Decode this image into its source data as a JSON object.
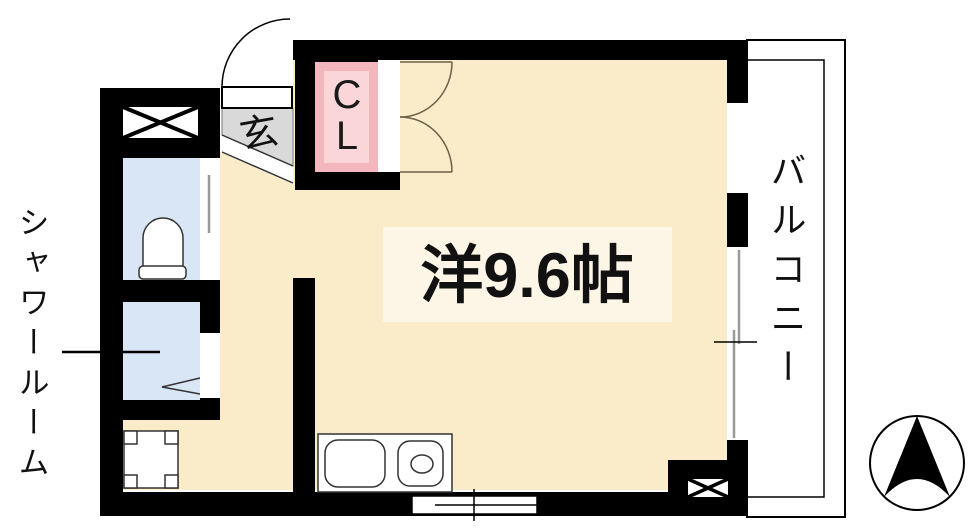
{
  "plan": {
    "title": "studio-apartment-floor-plan",
    "labels": {
      "main_room": "洋9.6帖",
      "balcony": "バルコニー",
      "shower_room": "シャワールーム",
      "entrance": "玄",
      "closet_line1": "C",
      "closet_line2": "L"
    },
    "icons": {
      "compass": "north-arrow-compass",
      "pipe_space_upper": "x-cross-box",
      "pipe_space_lower": "x-cross-box",
      "entrance_door": "quarter-arc-swing-door",
      "closet_doors": "double-swing-doors"
    },
    "colors": {
      "wall": "#000000",
      "floor": "#FAEBC9",
      "room_label_bg": "#FDF6E6",
      "genkan_gray": "#D9D9D9",
      "wet_room_blue": "#D8E6F5",
      "closet_frame_pink": "#F3B7BD",
      "closet_inner_pink": "#FAD6D9",
      "door_arc": "#6B6147"
    }
  }
}
